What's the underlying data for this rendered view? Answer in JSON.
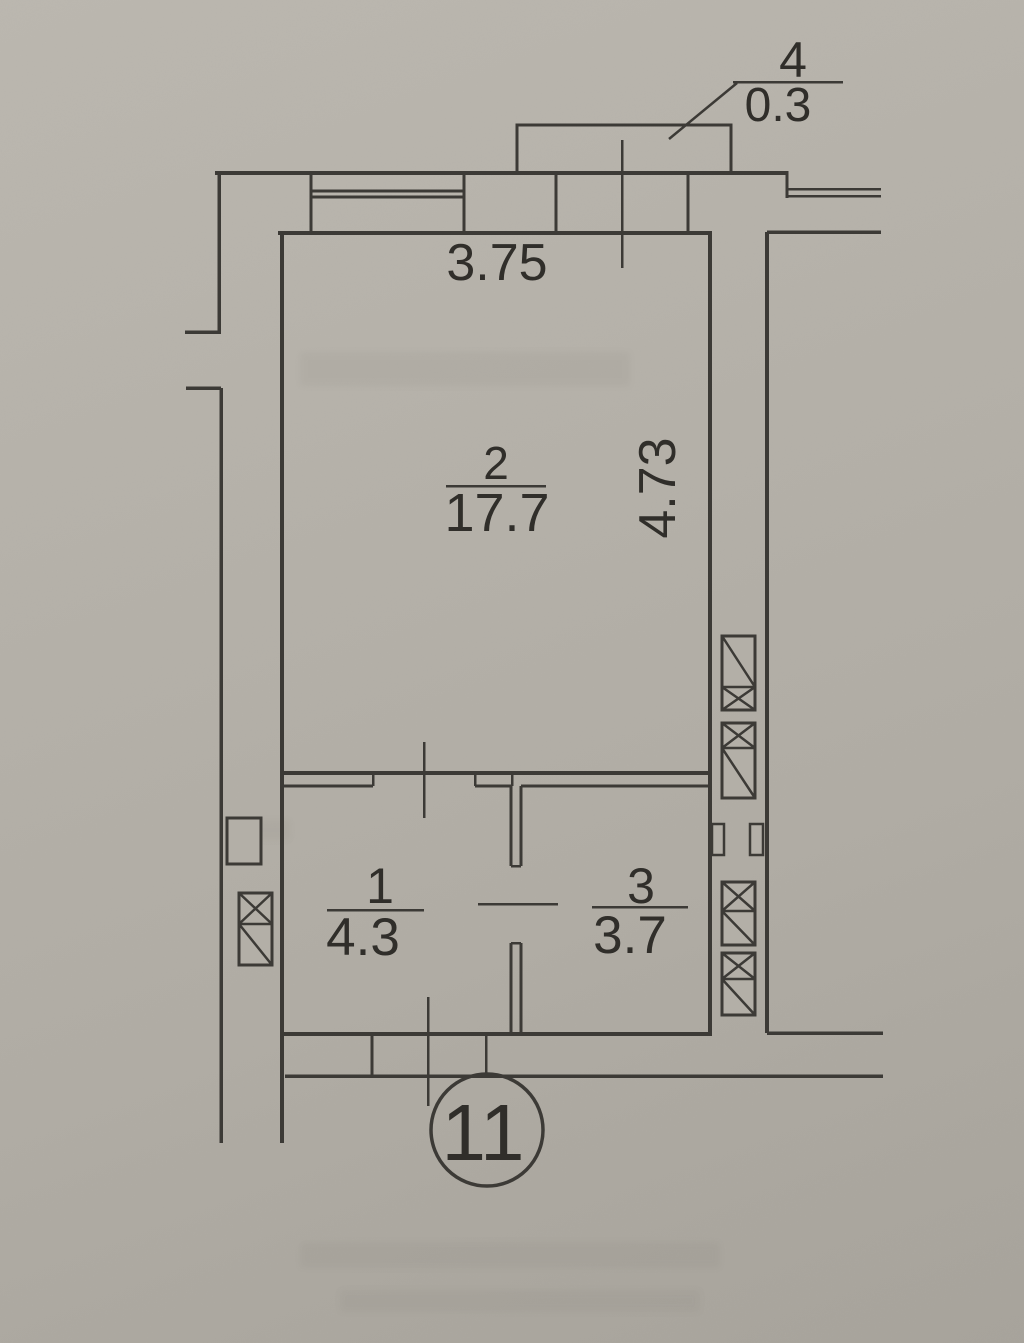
{
  "plan": {
    "type": "apartment-floor-plan",
    "unit_number": "11",
    "dimensions": {
      "top_width": "3.75",
      "right_height": "4.73"
    },
    "balcony": {
      "number": "4",
      "area": "0.3"
    },
    "rooms": [
      {
        "number": "2",
        "area": "17.7"
      },
      {
        "number": "1",
        "area": "4.3"
      },
      {
        "number": "3",
        "area": "3.7"
      }
    ]
  },
  "colors": {
    "paper": "#b5b1a9",
    "ink": "#3c3a36",
    "text": "#302e2a"
  }
}
